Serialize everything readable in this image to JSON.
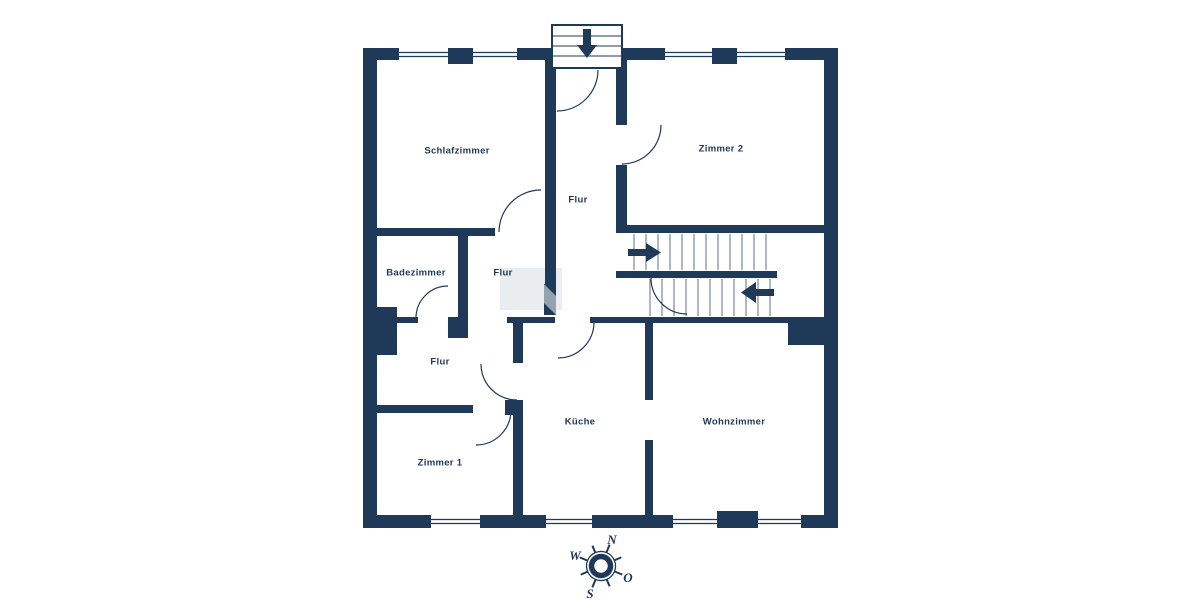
{
  "rooms": {
    "schlafzimmer": {
      "label": "Schlafzimmer"
    },
    "zimmer2": {
      "label": "Zimmer 2"
    },
    "flur_oben": {
      "label": "Flur"
    },
    "badezimmer": {
      "label": "Badezimmer"
    },
    "flur_mitte": {
      "label": "Flur"
    },
    "flur_unten": {
      "label": "Flur"
    },
    "kueche": {
      "label": "Küche"
    },
    "wohnzimmer": {
      "label": "Wohnzimmer"
    },
    "zimmer1": {
      "label": "Zimmer 1"
    }
  },
  "compass": {
    "north": "N",
    "west": "W",
    "east": "O",
    "south": "S"
  },
  "colors": {
    "wall": "#1f3a58",
    "background": "#ffffff",
    "step_line": "#5d6f86",
    "door_panel": "#95a2b2"
  }
}
